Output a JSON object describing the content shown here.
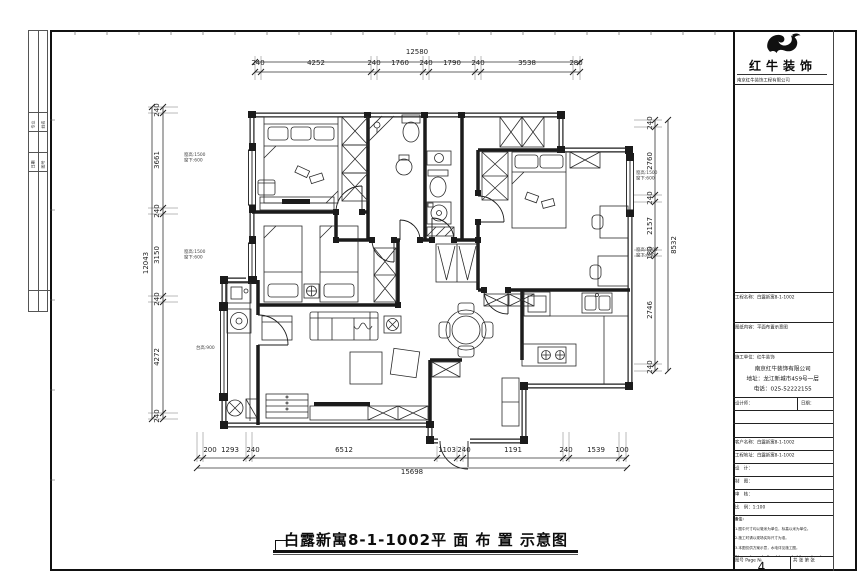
{
  "sheet": {
    "drawing_title": "白露新寓8-1-1002平 面 布 置 示意图",
    "page_number": "4"
  },
  "brand": {
    "name": "红牛装饰",
    "subtitle": "南京红牛装饰工程有限公司"
  },
  "title_block": {
    "row_project": "工程名称：白露新寓8-1-1002",
    "row_drawing": "图纸内容：平面布置示意图",
    "company_header": "施工单位：红牛装饰",
    "company_lines": [
      "南京红牛装饰有限公司",
      "地址：龙江新城市459号一层",
      "电话：025-52222155"
    ],
    "cell_designer": "设计师：",
    "cell_date": "日期：",
    "row_client": "客户名称：白露新寓8-1-1002",
    "row_address": "工程地址：白露新寓8-1-1002",
    "row_design": "设　计：",
    "row_draft": "制　图：",
    "row_check": "审　核：",
    "row_scale": "比　例：1:100",
    "notes_title": "备注：",
    "notes": [
      "1.图中尺寸均以毫米为单位，标高以米为单位。",
      "2.施工时请以现场实际尺寸为准。",
      "3.本图仅供方案示意，水电详见施工图。",
      "Dimensions shall not be scaled from drawing.",
      "Contractor must check all dimensions on site.",
      "Discrepancy shall be reported to the designer."
    ],
    "page_label": "图号 Page №.",
    "total_label": "共 张 第 张"
  },
  "sign_strip": {
    "cells": [
      "专业",
      "姓名",
      "日期",
      "图号"
    ]
  },
  "dims": {
    "top": {
      "total": "12580",
      "segments": [
        "240",
        "4252",
        "240",
        "1760",
        "240",
        "1790",
        "240",
        "3538",
        "280"
      ]
    },
    "left": {
      "total": "12043",
      "segments": [
        "240",
        "3661",
        "240",
        "3150",
        "240",
        "4272",
        "240"
      ]
    },
    "right": {
      "total": "8532",
      "segments": [
        "240",
        "2760",
        "240",
        "2157",
        "180",
        "2746",
        "240"
      ]
    },
    "bottom": {
      "total": "15698",
      "segments": [
        "200",
        "1293",
        "240",
        "6512",
        "1103",
        "240",
        "1191",
        "240",
        "1539",
        "100"
      ]
    }
  },
  "plan_notes": {
    "left1": [
      "窗高:1500",
      "窗下:600"
    ],
    "left2": [
      "窗高:1500",
      "窗下:600"
    ],
    "left3": [
      "台高:900"
    ],
    "right1": [
      "窗高:1500",
      "窗下:600"
    ],
    "right2": [
      "窗高:1500",
      "窗下:600"
    ]
  }
}
